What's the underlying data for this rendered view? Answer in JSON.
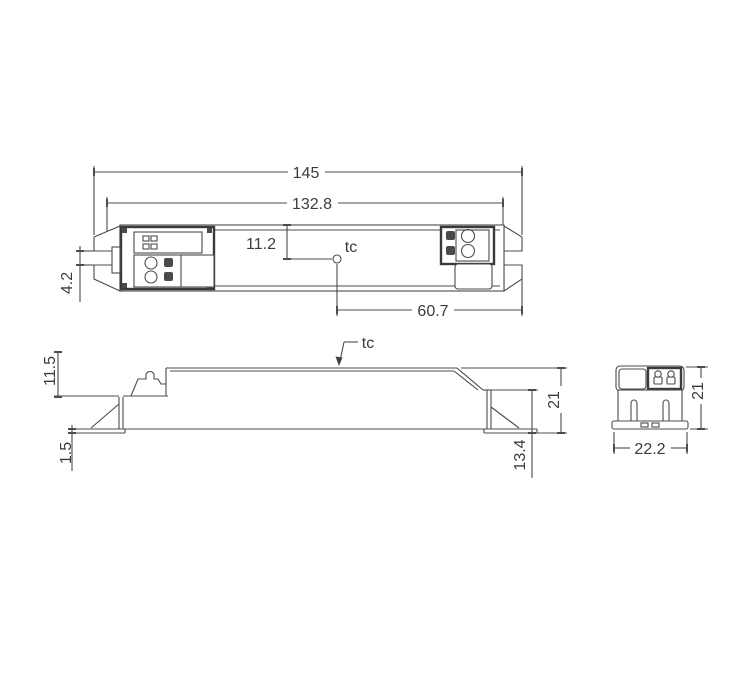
{
  "drawing": {
    "top_view": {
      "dim_overall_length": "145",
      "dim_body_length": "132.8",
      "dim_tc_vertical_offset": "11.2",
      "dim_slot_width": "4.2",
      "dim_tc_horizontal_offset": "60.7",
      "tc_label": "tc"
    },
    "side_view": {
      "dim_ledge_height": "11.5",
      "dim_foot_thickness": "1.5",
      "dim_total_height": "21",
      "dim_step_height": "13.4",
      "tc_label": "tc"
    },
    "end_view": {
      "dim_total_height": "21",
      "dim_total_width": "22.2"
    },
    "colors": {
      "line": "#4c4c4c",
      "dark_line": "#3a3a3a",
      "text": "#3c3c3c",
      "background": "#ffffff"
    }
  }
}
